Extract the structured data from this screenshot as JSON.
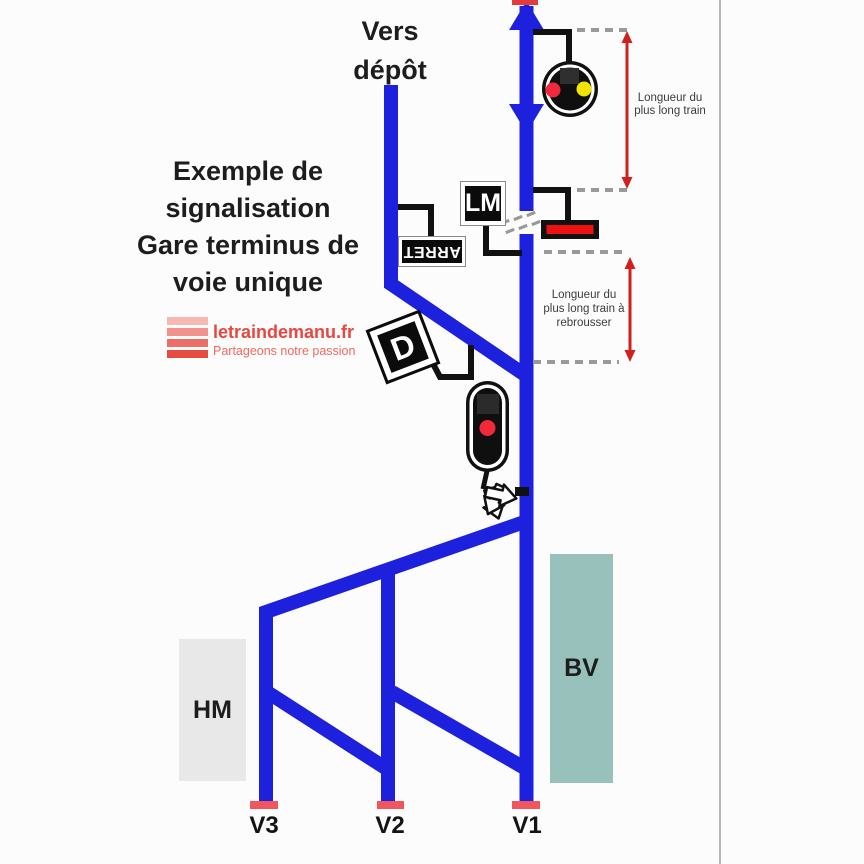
{
  "diagram": {
    "depot_label": {
      "line1": "Vers",
      "line2": "dépôt"
    },
    "title": {
      "line1": "Exemple de",
      "line2": "signalisation",
      "line3": "Gare terminus de",
      "line4": "voie unique"
    },
    "logo": {
      "site": "letraindemanu.fr",
      "tagline": "Partageons notre passion"
    },
    "signs": {
      "lm": "LM",
      "arret": "ARRET",
      "d": "D"
    },
    "measures": {
      "top": {
        "line1": "Longueur du",
        "line2": "plus long train"
      },
      "bottom": {
        "line1": "Longueur du",
        "line2": "plus long train à",
        "line3": "rebrousser"
      }
    },
    "station": {
      "halle": "HM",
      "batiment": "BV",
      "track1": "V1",
      "track2": "V2",
      "track3": "V3"
    },
    "colors": {
      "track_blue": "#1d20dc",
      "measure_red": "#cf2020",
      "buffer_stop_red": "#f0565c",
      "signal_red": "#f2293a",
      "signal_yellow": "#f0e400",
      "device_red": "#ee1111",
      "bv_teal": "#98c1bb",
      "hm_gray": "#e8e8e8",
      "logo_red": "#e8473e",
      "dash_gray": "#999999"
    }
  }
}
